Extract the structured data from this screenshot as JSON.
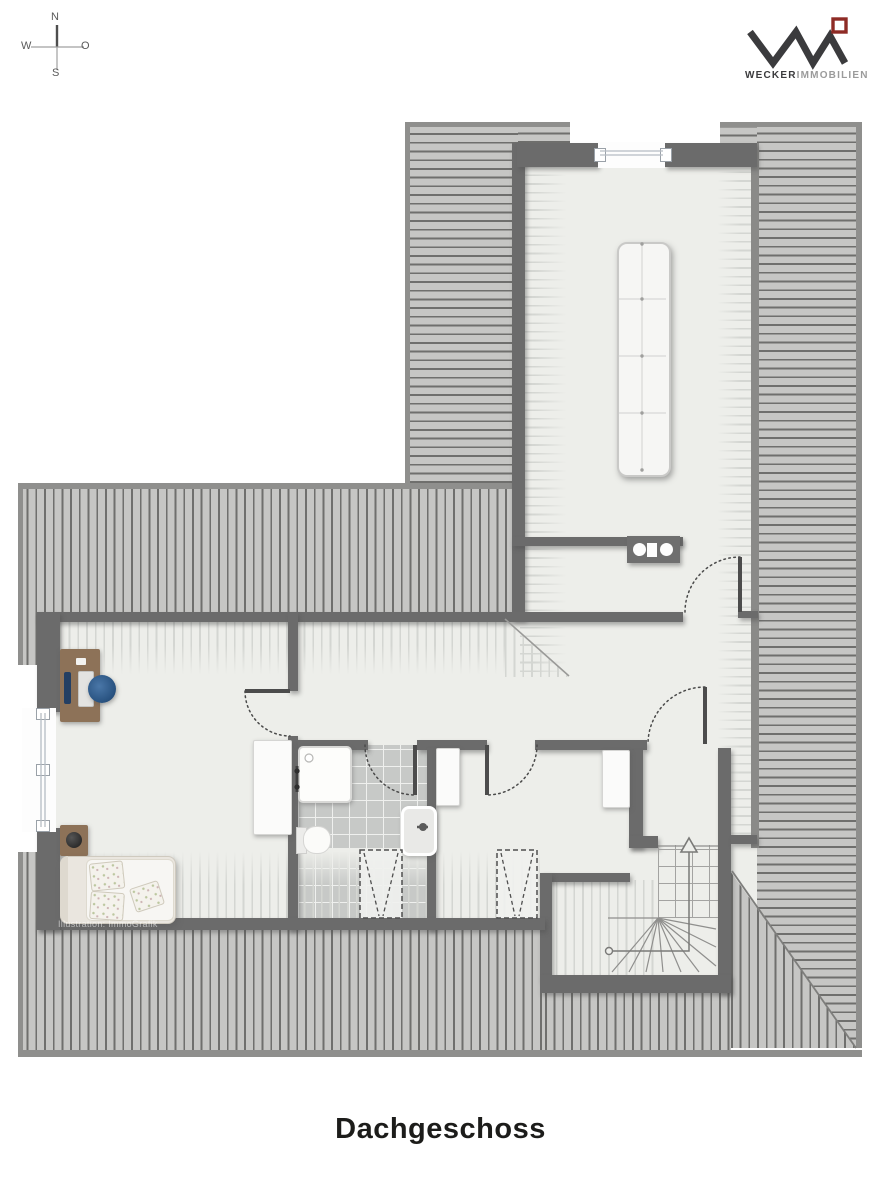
{
  "compass": {
    "north": "N",
    "east": "O",
    "south": "S",
    "west": "W"
  },
  "logo": {
    "primary": "WECKER",
    "secondary": "IMMOBILIEN",
    "mark_color": "#3b3b3d",
    "accent_color": "#8e2b25"
  },
  "floorplan": {
    "title": "Dachgeschoss",
    "credit": "Illustration: ImmoGrafik",
    "colors": {
      "wall": "#6b6b6b",
      "roof_fill": "#c6c6c4",
      "roof_stripe": "#6f6f6d",
      "floor": "#edeeea",
      "tiles": "#c7c9c7",
      "band_stripe": "#d4d6d2"
    },
    "symbols": [
      "compass-rose",
      "roof-hatching",
      "window",
      "skylight",
      "door-swing",
      "sofa",
      "kitchenette-counter",
      "shower",
      "toilet",
      "washbasin",
      "wardrobe",
      "bed",
      "pillow",
      "nightstand-lamp",
      "desk",
      "monitor",
      "keyboard",
      "office-chair",
      "staircase",
      "stair-direction-arrow"
    ]
  }
}
